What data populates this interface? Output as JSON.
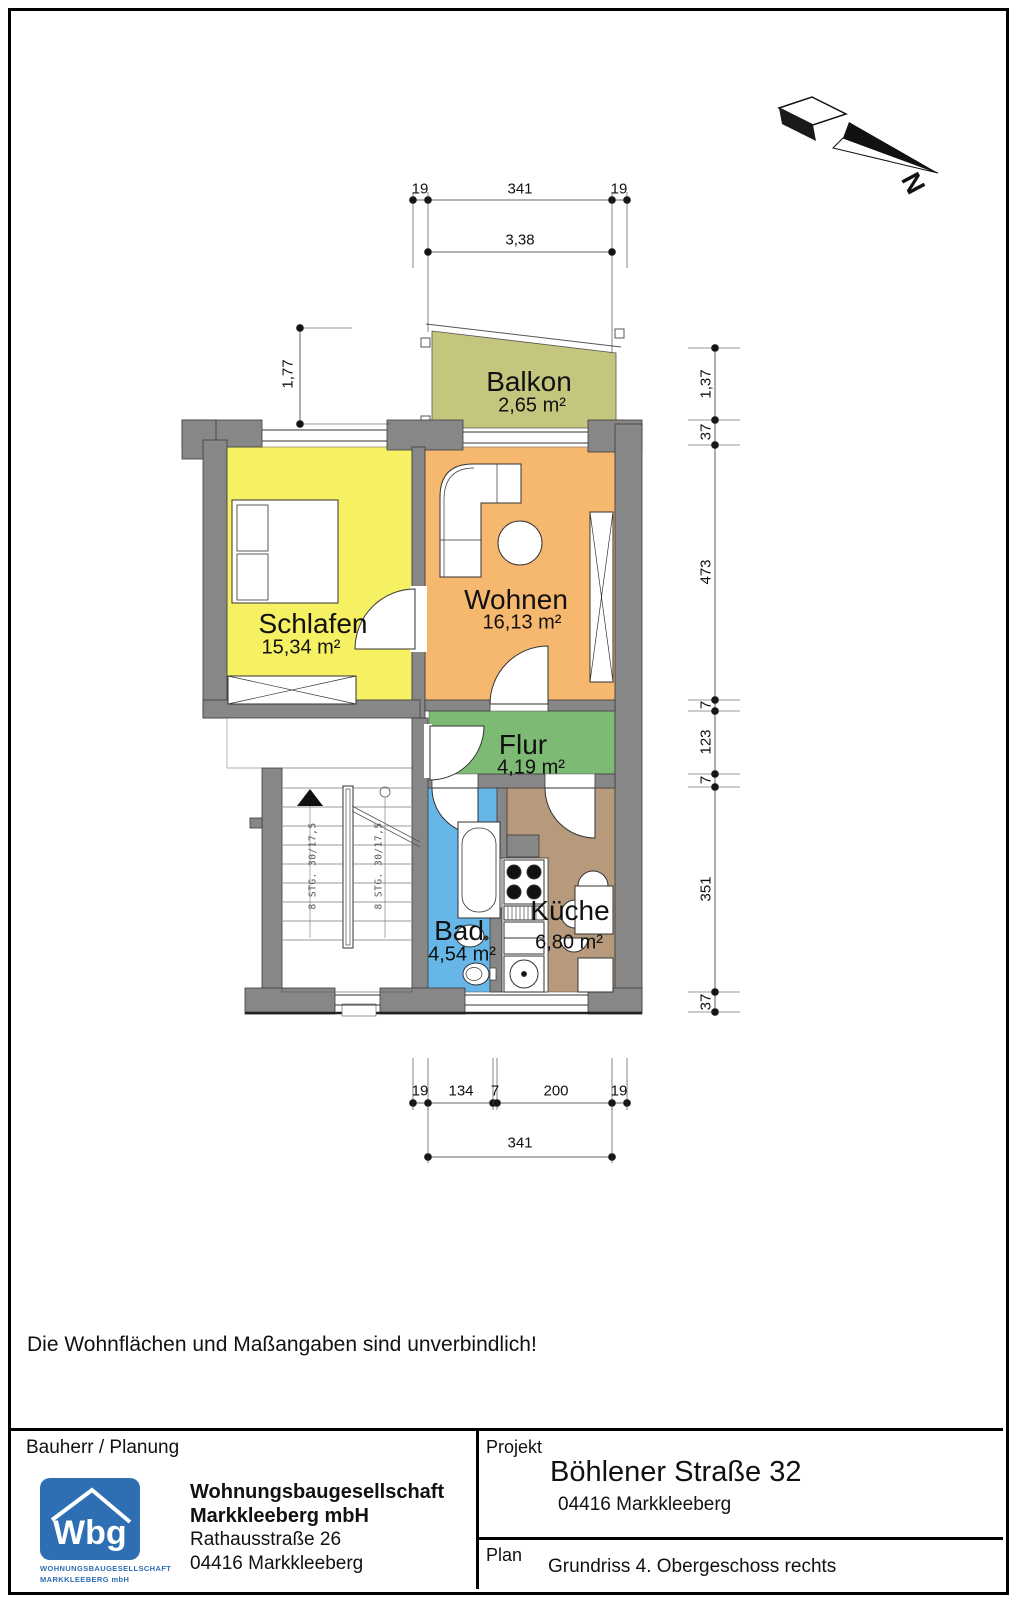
{
  "compass": {
    "label": "N"
  },
  "colors": {
    "wall": "#878787",
    "logo_blue": "#2e6fb3"
  },
  "rooms": [
    {
      "name": "Balkon",
      "area": "2,65 m²",
      "color": "#c4c67e"
    },
    {
      "name": "Schlafen",
      "area": "15,34 m²",
      "color": "#f6f063"
    },
    {
      "name": "Wohnen",
      "area": "16,13 m²",
      "color": "#f6b76f"
    },
    {
      "name": "Flur",
      "area": "4,19 m²",
      "color": "#7dbb74"
    },
    {
      "name": "Bad",
      "area": "4,54 m²",
      "color": "#66b6e8"
    },
    {
      "name": "Küche",
      "area": "6,80 m²",
      "color": "#b69a7b"
    }
  ],
  "dimensions": {
    "top_row1": [
      "19",
      "341",
      "19"
    ],
    "top_row2": "3,38",
    "left": "1,77",
    "right": [
      "1,37",
      "37",
      "473",
      "7",
      "123",
      "7",
      "351",
      "37"
    ],
    "bottom_row1": [
      "19",
      "134",
      "7",
      "200",
      "19"
    ],
    "bottom_row2": "341"
  },
  "stairs": {
    "flight1": "8 STG. 30/17,5",
    "flight2": "8 STG. 30/17,5"
  },
  "disclaimer": "Die Wohnflächen und Maßangaben sind unverbindlich!",
  "title_block": {
    "bauherr_label": "Bauherr / Planung",
    "logo_text": "Wbg",
    "logo_sub1": "WOHNUNGSBAUGESELLSCHAFT",
    "logo_sub2": "MARKKLEEBERG mbH",
    "company_line1": "Wohnungsbaugesellschaft",
    "company_line2": "Markkleeberg mbH",
    "company_line3": "Rathausstraße 26",
    "company_line4": "04416 Markkleeberg",
    "projekt_label": "Projekt",
    "projekt_name": "Böhlener Straße 32",
    "projekt_city": "04416 Markkleeberg",
    "plan_label": "Plan",
    "plan_name": "Grundriss 4. Obergeschoss rechts"
  }
}
